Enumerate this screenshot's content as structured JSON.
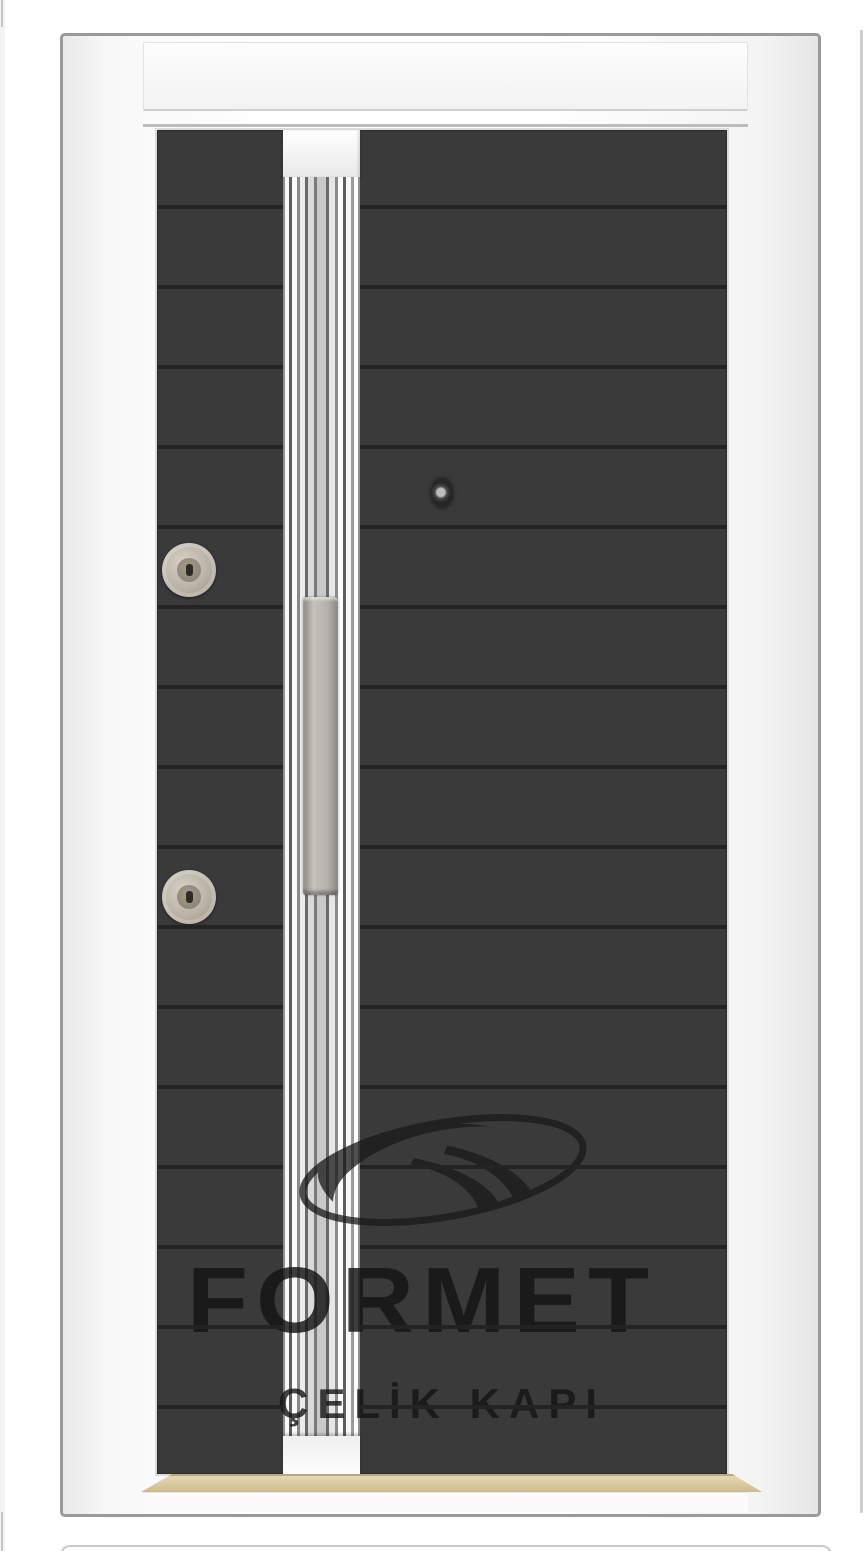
{
  "watermark": {
    "brand": "FORMET",
    "tagline": "ÇELİK KAPI"
  },
  "door": {
    "style": "steel-security-door",
    "panel_pattern": "horizontal-slats",
    "hardware": [
      "fluted-chrome-trim-strip",
      "vertical-bar-handle",
      "upper-lock-cylinder",
      "lower-lock-cylinder",
      "peephole-viewer",
      "gold-threshold"
    ]
  },
  "colors": {
    "page": "#ffffff",
    "card-border": "#9a9a9a",
    "frame": "#f7f7f7",
    "leaf": "#3a3a3a",
    "groove": "#232323",
    "handle": "#b5b1a9",
    "lock": "#b8b1a4",
    "threshold": "#d8c79c",
    "watermark": "#141414"
  }
}
